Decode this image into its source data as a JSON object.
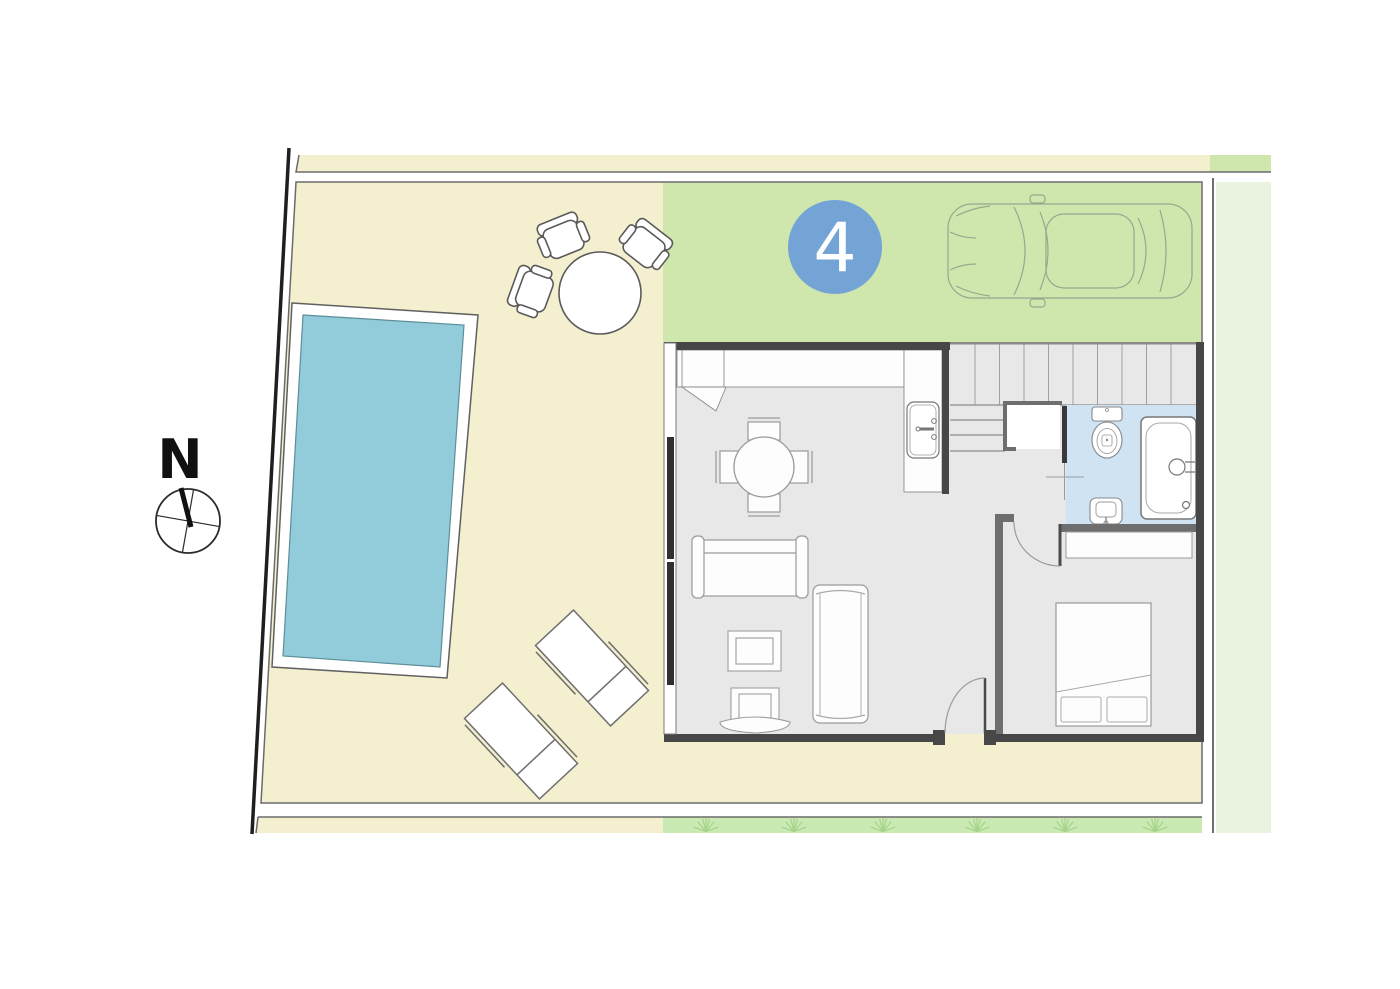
{
  "compass": {
    "label": "N"
  },
  "plot": {
    "number": "4"
  },
  "colors": {
    "terrace": "#f3efcf",
    "driveway": "#cfe7ad",
    "lawn": "#c9eab2",
    "fan": "#a6d28a",
    "neighbor": "#e9f3e0",
    "pool": "#92cbd9",
    "bathroom": "#cfe3f3",
    "floor": "#e8e8e8",
    "wall": "#474747",
    "wallmid": "#6e6e6e",
    "badge": "#74a3d6",
    "boundary": "#1f1f1f",
    "border": "#6b6b6b"
  }
}
